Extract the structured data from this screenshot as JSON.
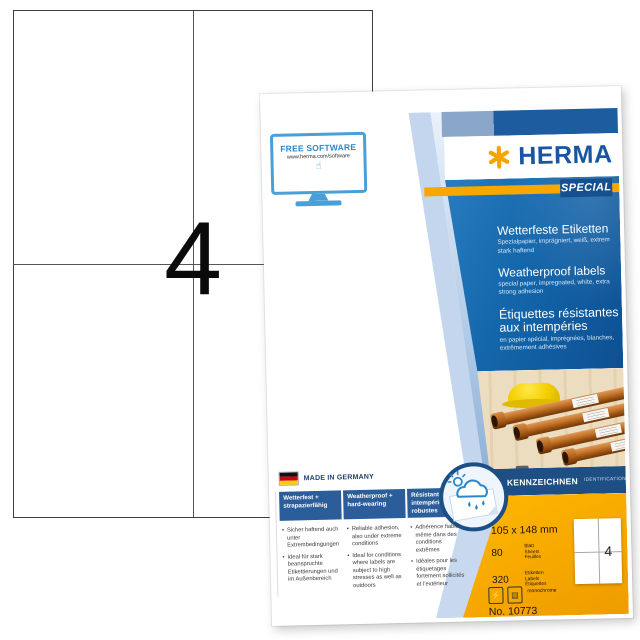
{
  "colors": {
    "herma_blue": "#1856a2",
    "herma_orange": "#f6a800",
    "band_navy": "#1d4e84",
    "panel_blue": "#1466ab"
  },
  "diagram": {
    "count": "4"
  },
  "pack": {
    "free_software": {
      "title": "FREE SOFTWARE",
      "url": "www.herma.com/software"
    },
    "brand": {
      "name": "HERMA",
      "series": "SPECIAL"
    },
    "claims": [
      {
        "title": "Wetterfeste Etiketten",
        "subtitle": "Spezialpapier, imprägniert, weiß, extrem stark haftend"
      },
      {
        "title": "Weatherproof labels",
        "subtitle": "special paper, impregnated, white, extra strong adhesion"
      },
      {
        "title": "Étiquettes résistantes aux intempéries",
        "subtitle": "en papier spécial, imprégnées, blanches, extrêmement adhésives"
      }
    ],
    "made_in": "MADE IN GERMANY",
    "features": [
      {
        "heading": "Wetterfest + strapazierfähig",
        "bullets": [
          "Sicher haftend auch unter Extrembedingungen",
          "Ideal für stark beanspruchte Etikettierungen und im Außenbereich"
        ]
      },
      {
        "heading": "Weatherproof + hard-wearing",
        "bullets": [
          "Reliable adhesion, also under extreme conditions",
          "Ideal for conditions where labels are subject to high stresses as well as outdoors"
        ]
      },
      {
        "heading": "Résistant aux intempéries + robustes",
        "bullets": [
          "Adhérence fiable même dans des conditions extrêmes",
          "Idéales pour les étiquetages fortement sollicités et l'extérieur"
        ]
      }
    ],
    "category": {
      "de": "KENNZEICHNEN",
      "en": "IDENTIFICATION"
    },
    "specs": {
      "size": "105 x 148 mm",
      "sheets_count": "80",
      "sheets_units": [
        "Blatt",
        "Sheets",
        "Feuilles"
      ],
      "labels_count": "320",
      "labels_units": [
        "Etiketten",
        "Labels",
        "Étiquettes"
      ],
      "print_mode": "monochrome",
      "article_no": "No. 10773",
      "labels_per_sheet": "4"
    }
  }
}
